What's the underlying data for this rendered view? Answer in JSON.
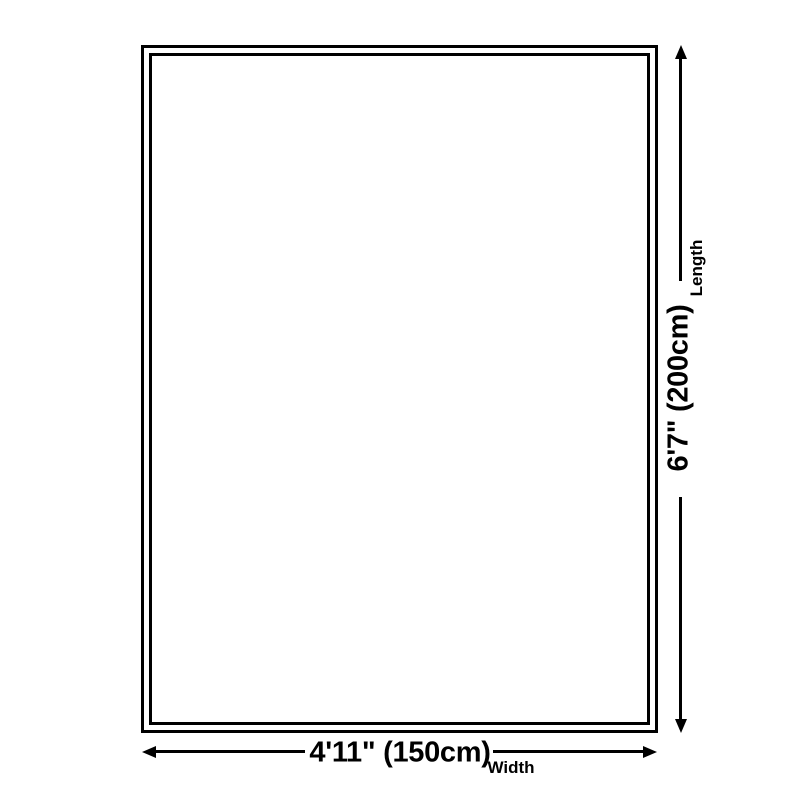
{
  "colors": {
    "background": "#ffffff",
    "line": "#000000",
    "text": "#000000"
  },
  "annotations": {
    "length": {
      "value": "6'7\" (200cm)",
      "label": "Length"
    },
    "width": {
      "value": "4'11\" (150cm)",
      "label": "Width"
    }
  },
  "icons": {
    "length_arrow": "double-headed-vertical-arrow",
    "width_arrow": "double-headed-horizontal-arrow"
  }
}
